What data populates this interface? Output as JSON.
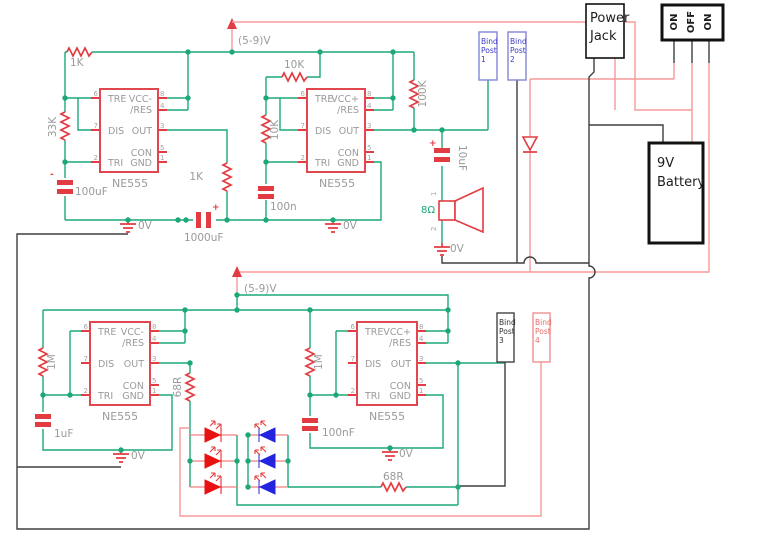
{
  "power": {
    "vcc_label": "(5-9)V",
    "gnd_label": "0V",
    "plus": "+",
    "minus": "-"
  },
  "ic_pins": {
    "tre": "TRE",
    "dis": "DIS",
    "tri": "TRI",
    "con": "CON",
    "res": "/RES",
    "out": "OUT",
    "gnd": "GND",
    "n1": "1",
    "n2": "2",
    "n3": "3",
    "n4": "4",
    "n5": "5",
    "n6": "6",
    "n7": "7",
    "n8": "8"
  },
  "ics": {
    "ic1": {
      "name": "NE555",
      "vcc": "VCC-"
    },
    "ic2": {
      "name": "NE555",
      "vcc": "VCC+"
    },
    "ic3": {
      "name": "NE555",
      "vcc": "VCC-"
    },
    "ic4": {
      "name": "NE555",
      "vcc": "VCC+"
    }
  },
  "parts": {
    "r_1k_top": "1K",
    "r_33k": "33K",
    "r_1k_mid": "1K",
    "r_10k_top": "10K",
    "r_10k_left": "10K",
    "r_100k": "100K",
    "r_1m_left": "1M",
    "r_1m_right": "1M",
    "r_68_left": "68R",
    "r_68_bottom": "68R",
    "c_100uf": "100uF",
    "c_1000uf": "1000uF",
    "c_100n": "100n",
    "c_10uf": "10uF",
    "c_1uf": "1uF",
    "c_100nf": "100nF",
    "speaker_impedance": "8Ω",
    "speaker_pin_1": "1",
    "speaker_pin_2": "2"
  },
  "modules": {
    "power_jack": {
      "line1": "Power",
      "line2": "Jack"
    },
    "toggle_switch": {
      "pos1": "ON",
      "pos2": "OFF",
      "pos3": "ON"
    },
    "battery": {
      "line1": "9V",
      "line2": "Battery"
    },
    "bind_post_1": {
      "l1": "Bind",
      "l2": "Post",
      "l3": "1"
    },
    "bind_post_2": {
      "l1": "Bind",
      "l2": "Post",
      "l3": "2"
    },
    "bind_post_3": {
      "l1": "Bind",
      "l2": "Post",
      "l3": "3"
    },
    "bind_post_4": {
      "l1": "Bind",
      "l2": "Post",
      "l3": "4"
    }
  },
  "colors": {
    "wire_green": "#1ca878",
    "wire_power_red": "#f59a98",
    "wire_black": "#3f3f3f",
    "component_red": "#e23b41",
    "label_gray": "#9a9a9a",
    "bind_post_blue": "#3939c8",
    "bind_post_red": "#e96a6a",
    "led_red": "#e81212",
    "led_blue": "#2323e0"
  }
}
